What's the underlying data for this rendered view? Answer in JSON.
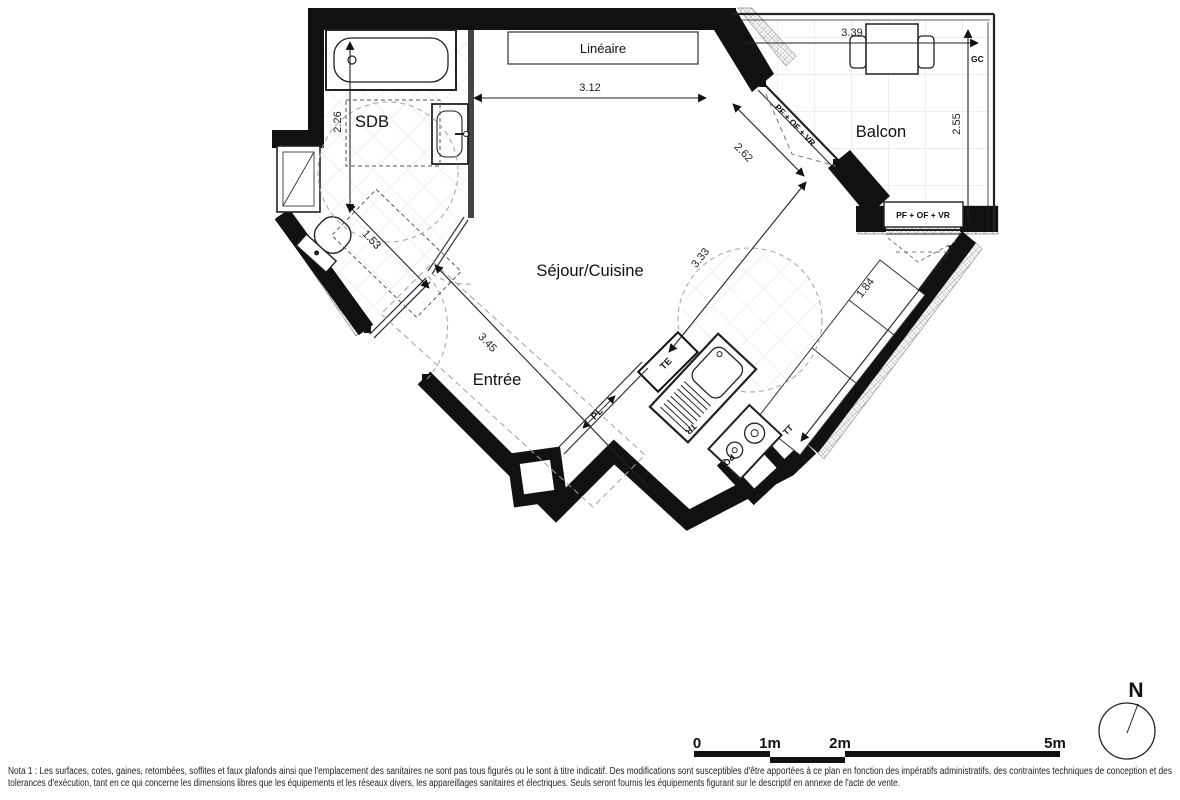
{
  "rooms": {
    "sdb": "SDB",
    "sejour": "Séjour/Cuisine",
    "balcon": "Balcon",
    "entree": "Entrée"
  },
  "boxes": {
    "lineaire": "Linéaire"
  },
  "openings": {
    "balcony_door": "PF + OF + VR",
    "balcony_window": "PF + OF + VR",
    "gc": "GC"
  },
  "kitchen_labels": {
    "te": "TE",
    "pl": "PL",
    "tr": "TR",
    "pq": "PQ",
    "tt": "TT",
    "rf": "RF"
  },
  "dims": {
    "d312": "3.12",
    "d339": "3.39",
    "d255": "2.55",
    "d226": "2.26",
    "d153": "1.53",
    "d345": "3.45",
    "d333": "3.33",
    "d184": "1.84",
    "d262": "2.62"
  },
  "scalebar": {
    "l0": "0",
    "l1": "1m",
    "l2": "2m",
    "l5": "5m"
  },
  "compass": {
    "north": "N"
  },
  "nota": {
    "line1": "Nota 1 : Les surfaces, cotes, gaines, retombées, soffites et faux plafonds ainsi que l'emplacement des sanitaires ne sont pas tous figurés ou le sont à titre indicatif. Des modifications sont susceptibles d'être apportées à ce plan en fonction des impératifs administratifs, des contraintes techniques de conception et des",
    "line2": "tolerances d'exécution, tant en ce qui concerne les dimensions libres que les équipements et les réseaux divers, les appareillages sanitaires et électriques. Seuls seront fournis les équipements figurant sur le descriptif en annexe de l'acte de vente."
  },
  "colors": {
    "wall": "#111111",
    "dim_line": "#222222",
    "tile": "#e0e0e0",
    "swing_dash": "#9aa0b8"
  }
}
